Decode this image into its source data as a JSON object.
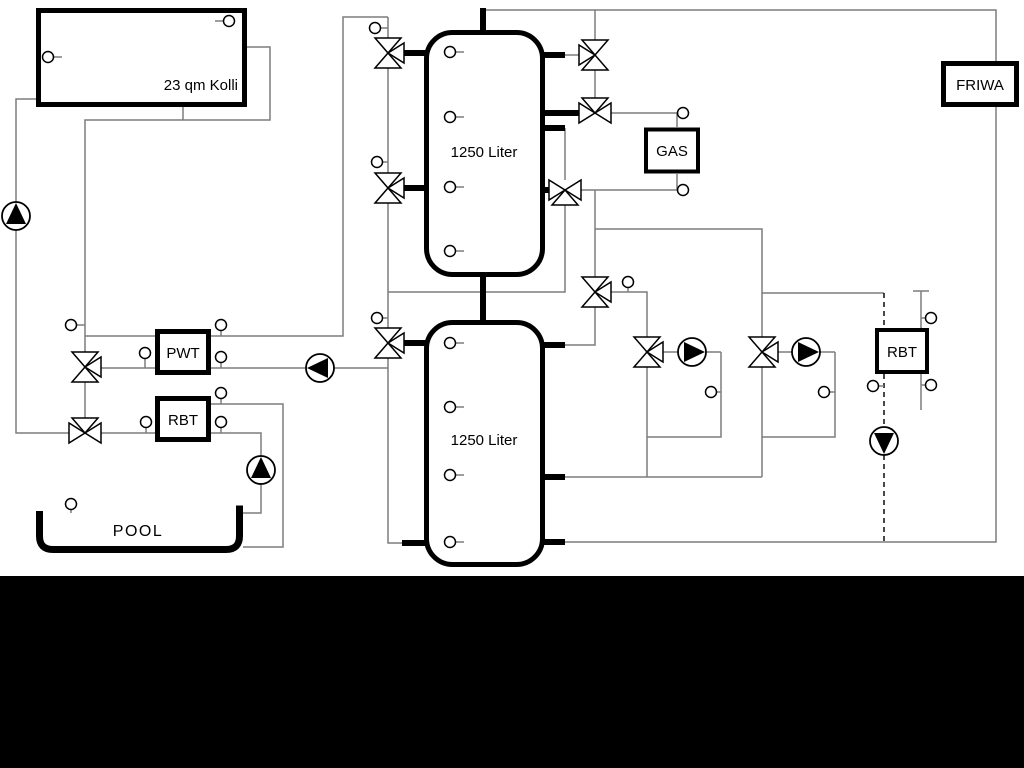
{
  "diagram": {
    "type": "hydraulic-schematic",
    "labels": {
      "collector": "23 qm Kolli",
      "tank_top": "1250 Liter",
      "tank_bottom": "1250 Liter",
      "pwt": "PWT",
      "rbt_pool": "RBT",
      "gas": "GAS",
      "rbt_dhw": "RBT",
      "friwa": "FRIWA",
      "pool": "POOL"
    },
    "colors": {
      "background": "#ffffff",
      "pipe": "#7d7d7d",
      "outline": "#000000",
      "bottom_mask": "#000000"
    },
    "counts": {
      "storage_tanks": 2,
      "pumps": 6,
      "three_way_valves": 11,
      "temperature_sensors": 25
    }
  }
}
